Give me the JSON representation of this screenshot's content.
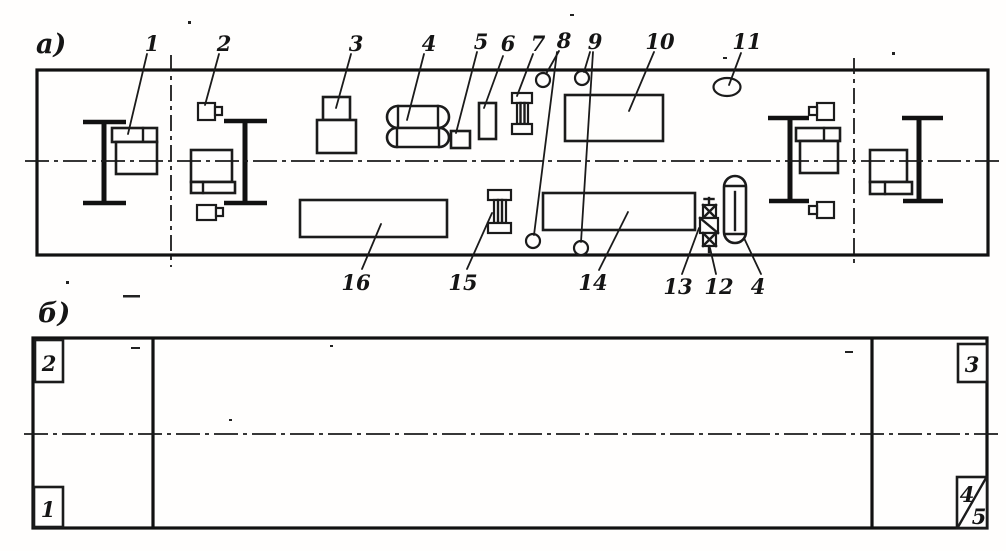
{
  "view_a": {
    "label": "а)",
    "callouts_top": [
      "1",
      "2",
      "3",
      "4",
      "5",
      "6",
      "7",
      "8",
      "9",
      "10",
      "11"
    ],
    "callouts_bottom": [
      "16",
      "15",
      "14",
      "13",
      "12",
      "4"
    ]
  },
  "view_b": {
    "label": "б)",
    "corner_top_left": "2",
    "corner_bottom_left": "1",
    "corner_top_right": "3",
    "corner_bottom_right_upper": "4",
    "corner_bottom_right_lower": "5"
  },
  "colors": {
    "ink": "#1b1b1b",
    "paper": "#fffefd"
  }
}
